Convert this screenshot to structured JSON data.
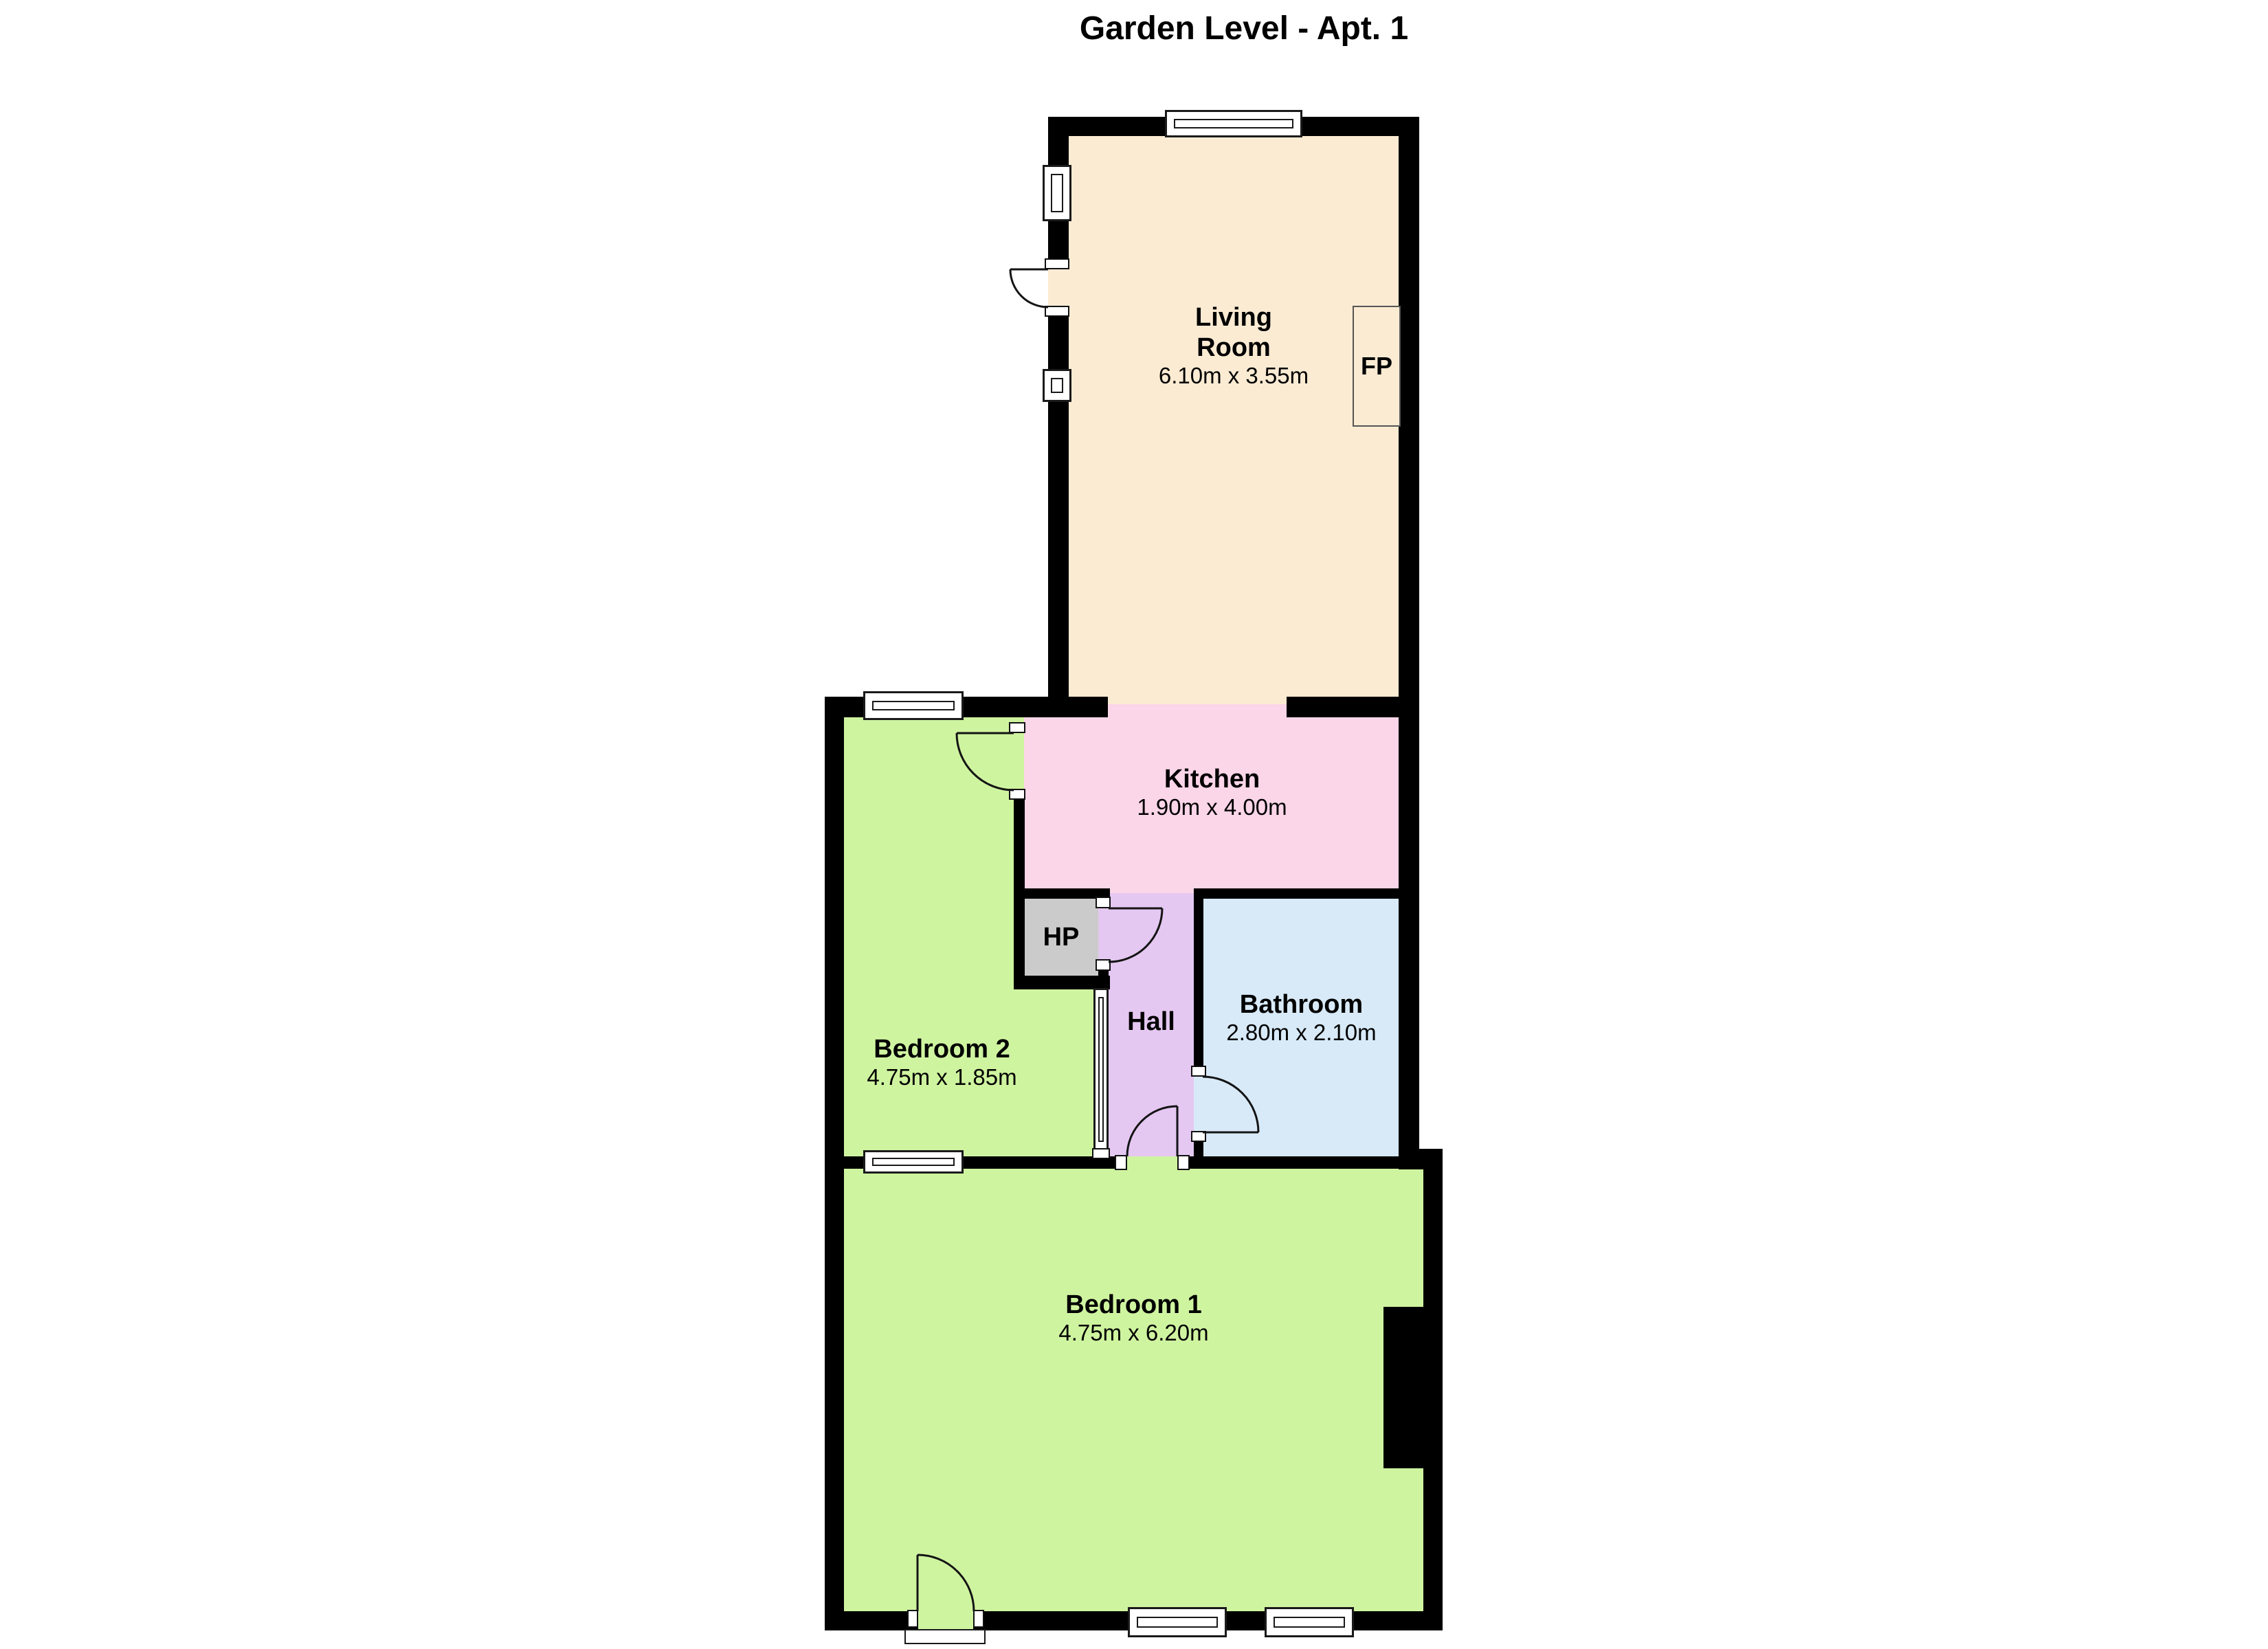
{
  "title": "Garden Level - Apt. 1",
  "background": "#ffffff",
  "wall_color": "#000000",
  "rooms": {
    "living_room": {
      "name_line1": "Living",
      "name_line2": "Room",
      "dims": "6.10m x 3.55m",
      "color": "#fbebd3"
    },
    "kitchen": {
      "name": "Kitchen",
      "dims": "1.90m x 4.00m",
      "color": "#fbd5e8"
    },
    "bathroom": {
      "name": "Bathroom",
      "dims": "2.80m x 2.10m",
      "color": "#d8eaf8"
    },
    "hall": {
      "name": "Hall",
      "color": "#e4c8f1"
    },
    "hot_press": {
      "name": "HP",
      "color": "#cbcbcb"
    },
    "bedroom_2": {
      "name": "Bedroom 2",
      "dims": "4.75m x 1.85m",
      "color": "#cff4a0"
    },
    "bedroom_1": {
      "name": "Bedroom 1",
      "dims": "4.75m x 6.20m",
      "color": "#cff4a0"
    },
    "fireplace": {
      "name": "FP"
    }
  }
}
